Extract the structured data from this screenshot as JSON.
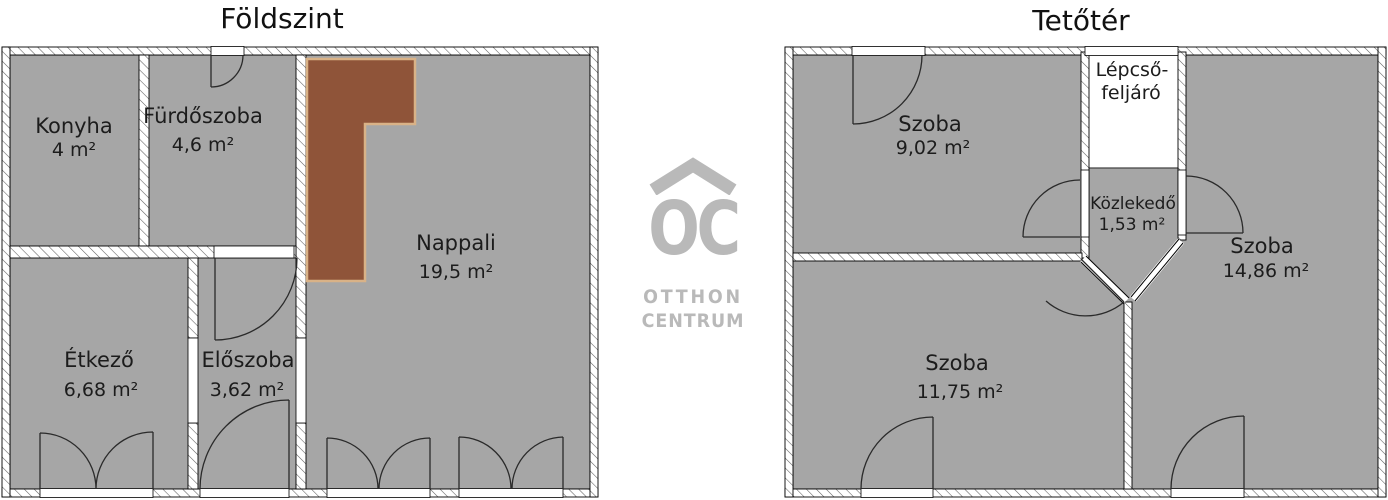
{
  "ground_floor": {
    "title": "Földszint",
    "rooms": [
      {
        "name": "Konyha",
        "area": "4 m²"
      },
      {
        "name": "Fürdőszoba",
        "area": "4,6 m²"
      },
      {
        "name": "Nappali",
        "area": "19,5 m²"
      },
      {
        "name": "Étkező",
        "area": "6,68 m²"
      },
      {
        "name": "Előszoba",
        "area": "3,62 m²"
      }
    ]
  },
  "attic_floor": {
    "title": "Tetőtér",
    "rooms": [
      {
        "name": "Szoba",
        "area": "9,02 m²"
      },
      {
        "name": "Szoba",
        "area": "14,86 m²"
      },
      {
        "name": "Szoba",
        "area": "11,75 m²"
      },
      {
        "name": "Közlekedő",
        "area": "1,53 m²"
      }
    ],
    "stairwell": {
      "line1": "Lépcső-",
      "line2": "feljáró"
    }
  },
  "logo": {
    "monogram": "OC",
    "name_line1": "OTTHON",
    "name_line2": "CENTRUM"
  },
  "colors": {
    "room_fill": "#a6a6a6",
    "feature_brown": "#8f5439",
    "feature_brown_edge": "#d9b287",
    "logo_gray": "#b9b9b9",
    "wall_fill": "#ffffff",
    "outline": "#000000"
  }
}
